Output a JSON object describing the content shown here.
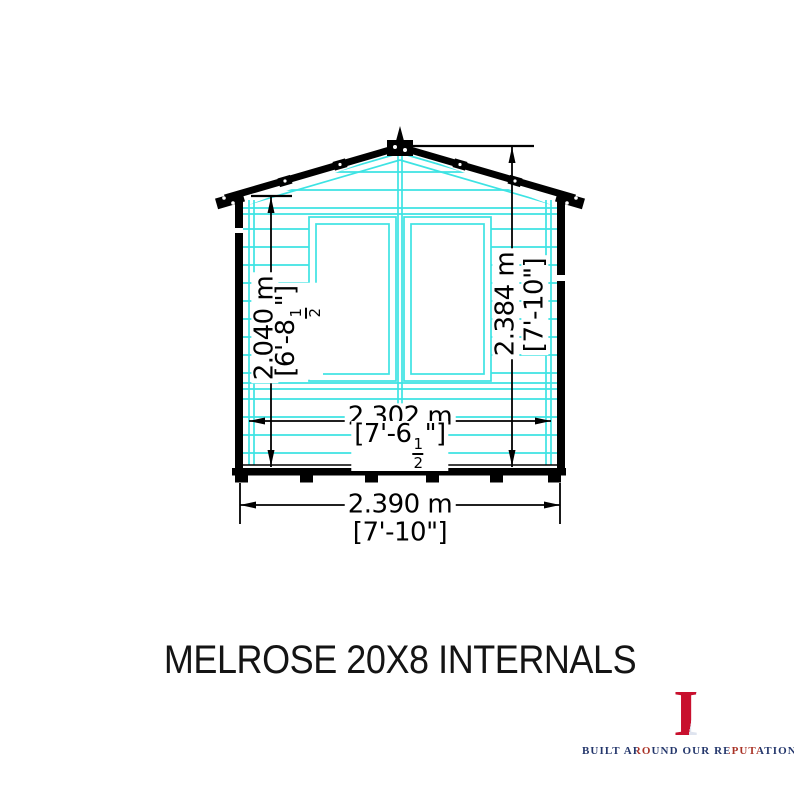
{
  "title": "MELROSE 20X8 INTERNALS",
  "diagram": {
    "description": "summerhouse front elevation internal dimensions",
    "colors": {
      "outline": "#000000",
      "framing": "#3DE3E3"
    },
    "dim_left_height": {
      "metric": "2.040 m",
      "imp_prefix": "[6'-8",
      "frac_num": "1",
      "frac_den": "2",
      "imp_suffix": "\"]"
    },
    "dim_right_height": {
      "metric": "2.384 m",
      "imperial": "[7'-10\"]"
    },
    "dim_internal_width": {
      "metric": "2.302 m",
      "imp_prefix": "[7'-6",
      "frac_num": "1",
      "frac_den": "2",
      "imp_suffix": "\"]"
    },
    "dim_overall_width": {
      "metric": "2.390 m",
      "imperial": "[7'-10\"]"
    }
  },
  "logo": {
    "letters": [
      "S",
      "H",
      "I",
      "R",
      "E"
    ],
    "tagline": "BUILT AROUND OUR REPUTATION",
    "colors": {
      "navy": "#1C2F6E",
      "red": "#C8102E",
      "silver": "#DFE4EF"
    }
  }
}
